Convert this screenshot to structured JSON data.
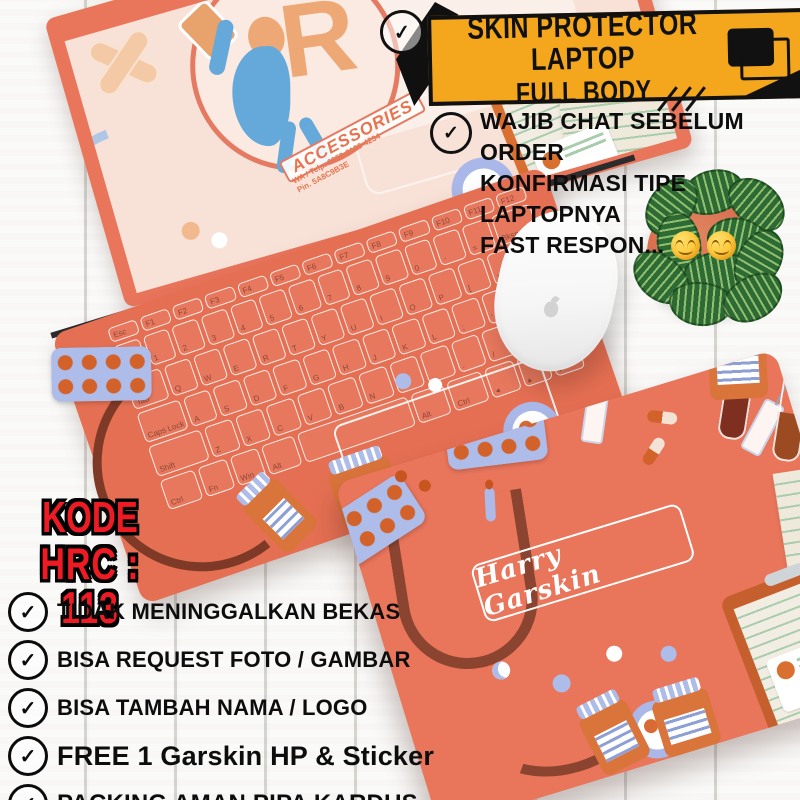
{
  "banner": {
    "line1": "SKIN PROTECTOR LAPTOP",
    "line2": "FULL BODY",
    "bg_color": "#F4A71D",
    "check_glyph": "✓"
  },
  "note": {
    "lines": [
      "WAJIB CHAT SEBELUM ORDER",
      "KONFIRMASI TIPE LAPTOPNYA",
      "FAST RESPON..."
    ],
    "emojis": "😊😊",
    "check_glyph": "✓"
  },
  "code": {
    "line1": "KODE",
    "line2": "HRC : 113",
    "color": "#EE1B24"
  },
  "checklist": {
    "check_glyph": "✓",
    "items": [
      {
        "label": "TIDAK MENINGGALKAN BEKAS"
      },
      {
        "label": "BISA REQUEST FOTO / GAMBAR"
      },
      {
        "label": "BISA TAMBAH NAMA / LOGO"
      },
      {
        "label": "FREE 1 Garskin HP & Sticker"
      },
      {
        "label": "PACKING AMAN PIPA KARDUS"
      }
    ]
  },
  "laptop_open": {
    "logo": {
      "letter": "R",
      "brand": "ACCESSORIES",
      "contact1": "WA / Telp. 0852-0120-4234",
      "contact2": "Pin. 5A8C9B3E"
    },
    "keyboard_rows": [
      [
        "Esc",
        "F1",
        "F2",
        "F3",
        "F4",
        "F5",
        "F6",
        "F7",
        "F8",
        "F9",
        "F10",
        "F11",
        "F12"
      ],
      [
        "`",
        "1",
        "2",
        "3",
        "4",
        "5",
        "6",
        "7",
        "8",
        "9",
        "0",
        "-",
        "=",
        "Bksp"
      ],
      [
        "Tab",
        "Q",
        "W",
        "E",
        "R",
        "T",
        "Y",
        "U",
        "I",
        "O",
        "P",
        "[",
        "]",
        "\\"
      ],
      [
        "Caps Lock",
        "A",
        "S",
        "D",
        "F",
        "G",
        "H",
        "J",
        "K",
        "L",
        ";",
        "'",
        "Enter"
      ],
      [
        "Shift",
        "Z",
        "X",
        "C",
        "V",
        "B",
        "N",
        "M",
        ",",
        ".",
        "/",
        "Shift"
      ],
      [
        "Ctrl",
        "Fn",
        "Win",
        "Alt",
        "Space",
        "Alt",
        "Ctrl",
        "◂",
        "▴",
        "▸"
      ]
    ]
  },
  "laptop_closed": {
    "name_label": "Harry Garskin"
  },
  "colors": {
    "skin_coral": "#E9755B",
    "screen_pink": "#F8E2D8",
    "banner_yellow": "#F4A71D",
    "code_red": "#EE1B24",
    "plant_green": "#2E6B34",
    "pot_orange": "#D9684A",
    "steth_brown": "#8A4430",
    "accent_blue": "#AEBCE9"
  }
}
